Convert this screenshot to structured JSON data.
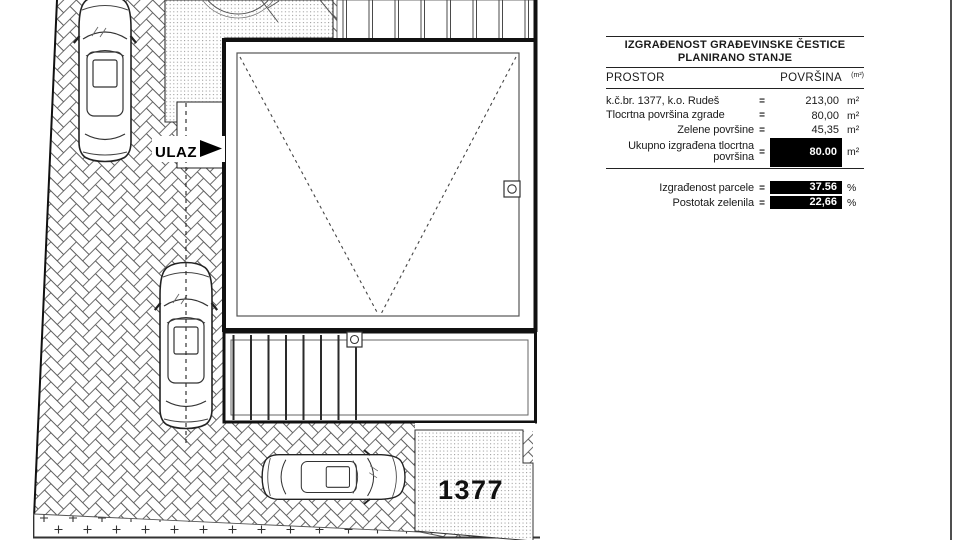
{
  "plan": {
    "entrance_label": "ULAZ",
    "parcel_number": "1377"
  },
  "table": {
    "title": [
      "IZGRAĐENOST GRAĐEVINSKE ČESTICE",
      "PLANIRANO STANJE"
    ],
    "header": {
      "label": "PROSTOR",
      "value": "POVRŠINA",
      "note": "(m²)"
    },
    "rows": [
      {
        "label": "k.č.br. 1377, k.o. Rudeš",
        "sign": "=",
        "value": "213,00",
        "unit": "m²"
      },
      {
        "label": "Tlocrtna površina zgrade",
        "sign": "=",
        "value": "80,00",
        "unit": "m²"
      },
      {
        "label": "Zelene površine",
        "sign": "=",
        "value": "45,35",
        "unit": "m²"
      },
      {
        "label": "Ukupno izgrađena tlocrtna površina",
        "sign": "=",
        "value": "80.00",
        "unit": "m²"
      }
    ],
    "summary": [
      {
        "label": "Izgrađenost parcele",
        "sign": "=",
        "value": "37.56",
        "unit": "%"
      },
      {
        "label": "Postotak zelenila",
        "sign": "=",
        "value": "22,66",
        "unit": "%"
      }
    ]
  },
  "colors": {
    "highlight_bg": "#000000",
    "highlight_text": "#ffffff",
    "line": "#1a1a1a"
  }
}
